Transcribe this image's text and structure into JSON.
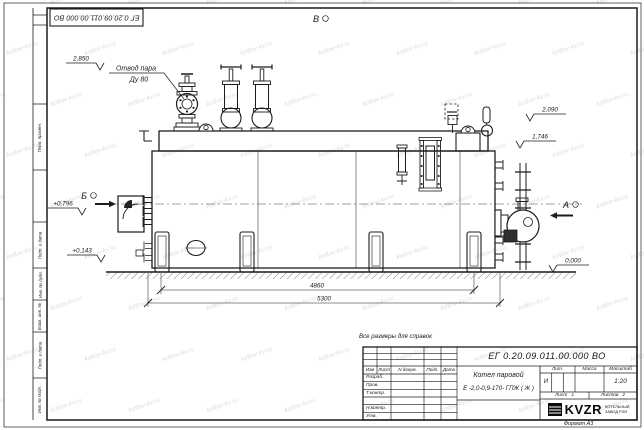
{
  "watermark": {
    "text": "kotlov-kv.ru"
  },
  "sheet": {
    "top_stamp": "ЕГ 0.20.09.011.00.000  ВО",
    "format_note": "Формат А3",
    "reference_note": "Все размеры для справок",
    "left_column_labels": [
      "Перв. примен.",
      "Подп. и дата",
      "Инв. № дубл.",
      "Взам. инв. №",
      "Подп. и дата",
      "Инв. № подл."
    ]
  },
  "annotations": {
    "steam_outlet": {
      "line1": "Отвод пара",
      "line2": "Ду 80"
    },
    "views": {
      "a": "А",
      "b": "Б",
      "v": "В"
    },
    "elevations": {
      "top_valve": "2,850",
      "drum_top": "2,090",
      "body_top": "1,746",
      "front_upper": "+0,796",
      "front_lower": "+0,143",
      "ground": "0,000"
    },
    "dimensions": {
      "support_span": "4860",
      "overall_length": "5300"
    }
  },
  "titleblock": {
    "doc_number": "ЕГ 0.20.09.011.00.000  ВО",
    "product_line1": "Котел паровой",
    "product_line2": "Е -2,0-0,9-170- ГПЖ ( Ж )",
    "columns": {
      "izm": "Изм",
      "list": "Лист",
      "doc": "N докум.",
      "podp": "Подп.",
      "data": "Дата"
    },
    "roles": [
      "Разраб.",
      "Пров.",
      "Т.контр.",
      "Н.контр.",
      "Утв."
    ],
    "lit": {
      "header": "Лит.",
      "value": "И"
    },
    "mass": {
      "header": "Масса",
      "value": ""
    },
    "scale": {
      "header": "Масштаб",
      "value": "1:20"
    },
    "sheet_cell": {
      "label": "Лист",
      "value": "1"
    },
    "sheets_cell": {
      "label": "Листов",
      "value": "2"
    },
    "logo": {
      "text": "KVZR",
      "sub1": "КОТЕЛЬНЫЙ",
      "sub2": "ЗАВОД РЭП"
    }
  }
}
